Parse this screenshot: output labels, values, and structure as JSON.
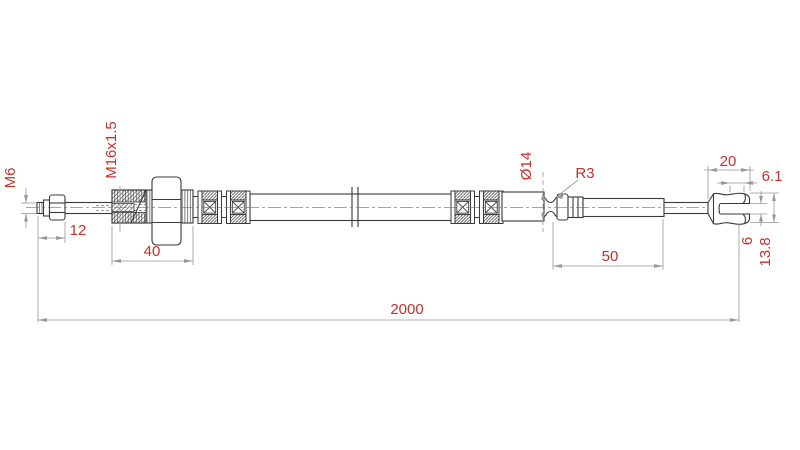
{
  "drawing": {
    "type": "technical-drawing",
    "part": "cable-assembly-side-view",
    "colors": {
      "background": "#ffffff",
      "outline": "#3a3a3a",
      "dimension_lines": "#979797",
      "dimension_text": "#c2312e"
    },
    "dimensions": [
      {
        "name": "left-tip-thread-size",
        "label": "M6"
      },
      {
        "name": "adjuster-thread-size",
        "label": "M16x1.5"
      },
      {
        "name": "left-tip-thread-length",
        "label": "12"
      },
      {
        "name": "adjuster-body-length",
        "label": "40"
      },
      {
        "name": "ferrule-diameter",
        "label": "Ø14"
      },
      {
        "name": "groove-radius",
        "label": "R3"
      },
      {
        "name": "rod-length",
        "label": "50"
      },
      {
        "name": "fork-length",
        "label": "20"
      },
      {
        "name": "fork-tip-width",
        "label": "6.1"
      },
      {
        "name": "fork-slot-height",
        "label": "6"
      },
      {
        "name": "fork-outer-diameter",
        "label": "13.8"
      },
      {
        "name": "total-length",
        "label": "2000"
      }
    ]
  }
}
